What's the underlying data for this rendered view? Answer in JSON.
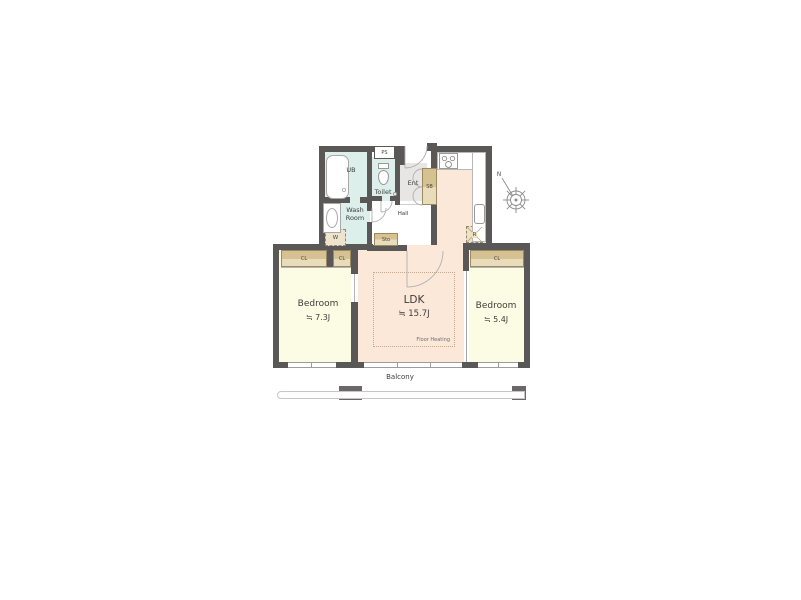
{
  "colors": {
    "wall": "#5a5757",
    "wet_area": "#dcefeb",
    "bedroom": "#fcfbe3",
    "ldk": "#fbe8d9",
    "storage": "#d6c193",
    "storage_light": "#e9dcba",
    "entrance": "#e7e6e5",
    "window_frame": "#9c9c9c",
    "door_arc": "#b0b0b0",
    "balcony_rail": "#c6c6c6",
    "balcony_post": "#6a6868"
  },
  "rooms": {
    "ub": {
      "label": "UB"
    },
    "toilet": {
      "label": "Toilet"
    },
    "wash_room": {
      "label": "Wash\nRoom"
    },
    "ent": {
      "label": "Ent"
    },
    "hall": {
      "label": "Hall"
    },
    "ldk": {
      "label": "LDK",
      "size": "≒ 15.7J",
      "note": "Floor Heating"
    },
    "bedroom_left": {
      "label": "Bedroom",
      "size": "≒ 7.3J"
    },
    "bedroom_right": {
      "label": "Bedroom",
      "size": "≒ 5.4J"
    }
  },
  "fixtures": {
    "ps": "PS",
    "sb": "SB",
    "sto": "Sto",
    "washer": "W",
    "fridge": "R",
    "closet": "CL"
  },
  "outdoor": {
    "balcony": "Balcony"
  },
  "compass": {
    "north": "N"
  }
}
